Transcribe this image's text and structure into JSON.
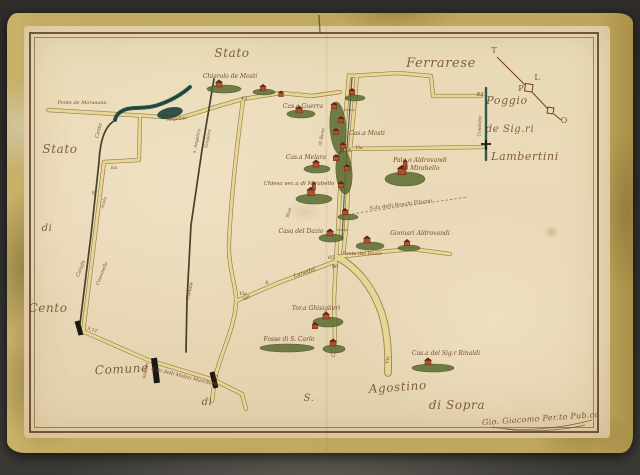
{
  "colors": {
    "photo_bg": "#2e2d2a",
    "margin": "#bfa65e",
    "paper": "#e9dbb6",
    "frame": "#53301c",
    "ink": "#6b4423",
    "ink_red": "#7a3b24",
    "road_fill": "#e7d795",
    "road_edge": "#8a6a38",
    "canal_dark": "#46412c",
    "water_teal": "#2c5a4e",
    "green_dark": "#5c6b31",
    "house_wall": "#b0512c",
    "house_roof": "#5f2714",
    "black": "#1c1812"
  },
  "map": {
    "labels": [
      {
        "name": "stato-top",
        "text": "Stato",
        "x": 232,
        "y": 57,
        "s": 12,
        "r": 0,
        "c": "big"
      },
      {
        "name": "ferrarese",
        "text": "Ferrarese",
        "x": 441,
        "y": 67,
        "s": 13,
        "r": 0,
        "c": "big"
      },
      {
        "name": "stato-left",
        "text": "Stato",
        "x": 60,
        "y": 153,
        "s": 12,
        "r": 0,
        "c": "big"
      },
      {
        "name": "di-left",
        "text": "di",
        "x": 47,
        "y": 231,
        "s": 10,
        "r": 0,
        "c": "big"
      },
      {
        "name": "cento",
        "text": "Cento",
        "x": 48,
        "y": 312,
        "s": 12,
        "r": 0,
        "c": "big"
      },
      {
        "name": "comune",
        "text": "Comune",
        "x": 122,
        "y": 373,
        "s": 12,
        "r": -3,
        "c": "big"
      },
      {
        "name": "di-bottom",
        "text": "di",
        "x": 207,
        "y": 405,
        "s": 10,
        "r": 0,
        "c": "big"
      },
      {
        "name": "s-bottom",
        "text": "S.",
        "x": 309,
        "y": 401,
        "s": 10,
        "r": 0,
        "c": "big"
      },
      {
        "name": "agostino",
        "text": "Agostino",
        "x": 398,
        "y": 391,
        "s": 12,
        "r": -4,
        "c": "big"
      },
      {
        "name": "di-sopra",
        "text": "di Sopra",
        "x": 457,
        "y": 409,
        "s": 12,
        "r": 0,
        "c": "big"
      },
      {
        "name": "poggio",
        "text": "Poggio",
        "x": 507,
        "y": 104,
        "s": 11,
        "r": 0,
        "c": "big"
      },
      {
        "name": "de-sigri",
        "text": "de Sig.ri",
        "x": 510,
        "y": 132,
        "s": 10,
        "r": 0,
        "c": "big"
      },
      {
        "name": "lambertini",
        "text": "Lambertini",
        "x": 525,
        "y": 160,
        "s": 11,
        "r": 0,
        "c": "big"
      },
      {
        "name": "chiarolo-de-mosti",
        "text": "Chiarolo de Mosti",
        "x": 230,
        "y": 78,
        "s": 6,
        "r": 0,
        "c": "small"
      },
      {
        "name": "ponte-de-morasana",
        "text": "Ponte de Morasana",
        "x": 82,
        "y": 104,
        "s": 5,
        "r": 0,
        "c": "small"
      },
      {
        "name": "casa-guerra",
        "text": "Cas.a Guerra",
        "x": 303,
        "y": 108,
        "s": 6,
        "r": 0,
        "c": "small"
      },
      {
        "name": "casa-mosti",
        "text": "Cas.a Mosti",
        "x": 367,
        "y": 135,
        "s": 6,
        "r": 0,
        "c": "small"
      },
      {
        "name": "casa-melara",
        "text": "Cas.a Melara",
        "x": 306,
        "y": 159,
        "s": 6,
        "r": 0,
        "c": "small"
      },
      {
        "name": "chiesa-vecchia-mirabello",
        "text": "Chiesa vec.a di Mirabello",
        "x": 299,
        "y": 185,
        "s": 5.5,
        "r": 0,
        "c": "small"
      },
      {
        "name": "casa-del-dazio",
        "text": "Casa del Dazio",
        "x": 301,
        "y": 233,
        "s": 6,
        "r": 0,
        "c": "small"
      },
      {
        "name": "palazzo-aldrovandi-line1",
        "text": "Palg.o Aldrovandi",
        "x": 420,
        "y": 162,
        "s": 6,
        "r": 0,
        "c": "small"
      },
      {
        "name": "palazzo-aldrovandi-line2",
        "text": "di Mirabello",
        "x": 421,
        "y": 170,
        "s": 6,
        "r": 0,
        "c": "small"
      },
      {
        "name": "gonnari-aldrovandi",
        "text": "Gonnari Aldrovandi",
        "x": 420,
        "y": 235,
        "s": 6,
        "r": 0,
        "c": "small"
      },
      {
        "name": "ponte-del-dazio",
        "text": "Ponte del Dazio",
        "x": 362,
        "y": 255,
        "s": 5,
        "r": 0,
        "c": "small"
      },
      {
        "name": "torre-ghisiglieri",
        "text": "Tor.a Ghisiglieri",
        "x": 316,
        "y": 310,
        "s": 6,
        "r": 0,
        "c": "small"
      },
      {
        "name": "fosse-di-s-carlo",
        "text": "Fosse di S. Carlo",
        "x": 289,
        "y": 341,
        "s": 6,
        "r": 0,
        "c": "small"
      },
      {
        "name": "casa-rinaldi",
        "text": "Cas.a del Sig.r Rinaldi",
        "x": 446,
        "y": 355,
        "s": 6,
        "r": 0,
        "c": "small"
      },
      {
        "name": "strada-molini-marchetti",
        "text": "S.da delli Molini Marchetti",
        "x": 184,
        "y": 378,
        "s": 5,
        "r": 14,
        "c": "small"
      },
      {
        "name": "strada-ronchi-filzano",
        "text": "S.da delli Ronchi Filzano",
        "x": 401,
        "y": 206,
        "s": 5,
        "r": -7,
        "c": "small"
      },
      {
        "name": "lunedel",
        "text": "Lunedel",
        "x": 305,
        "y": 274,
        "s": 5.5,
        "r": -18,
        "c": "small"
      },
      {
        "name": "signature",
        "text": "Gio. Giacomo Per.to Pub.co",
        "x": 541,
        "y": 421,
        "s": 8,
        "r": -4,
        "c": "sig"
      },
      {
        "name": "num-43",
        "text": "43",
        "x": 244,
        "y": 100,
        "s": 5,
        "r": 0,
        "c": "tiny"
      },
      {
        "name": "num-83",
        "text": "83.",
        "x": 481,
        "y": 96,
        "s": 5.5,
        "r": 0,
        "c": "tiny"
      },
      {
        "name": "num-44",
        "text": "44",
        "x": 348,
        "y": 151,
        "s": 5,
        "r": 0,
        "c": "tiny"
      },
      {
        "name": "via-near-44",
        "text": "Via",
        "x": 359,
        "y": 149,
        "s": 4.5,
        "r": 0,
        "c": "tiny"
      },
      {
        "name": "num-85",
        "text": "85",
        "x": 331,
        "y": 259,
        "s": 5,
        "r": 0,
        "c": "tiny"
      },
      {
        "name": "num-80",
        "text": "80",
        "x": 335,
        "y": 268,
        "s": 5,
        "r": 0,
        "c": "tiny"
      },
      {
        "name": "num-h12",
        "text": "h.12",
        "x": 92,
        "y": 331,
        "s": 4.5,
        "r": 18,
        "c": "tiny"
      },
      {
        "name": "num-813",
        "text": "8.13",
        "x": 217,
        "y": 380,
        "s": 4.5,
        "r": -75,
        "c": "tiny"
      },
      {
        "name": "letter-b",
        "text": "b",
        "x": 267,
        "y": 284,
        "s": 5,
        "r": 0,
        "c": "tiny"
      },
      {
        "name": "val",
        "text": "Val",
        "x": 247,
        "y": 299,
        "s": 4.5,
        "r": -30,
        "c": "tiny"
      },
      {
        "name": "via-west",
        "text": "via",
        "x": 114,
        "y": 169,
        "s": 4.5,
        "r": 0,
        "c": "tiny"
      },
      {
        "name": "via-center",
        "text": "Via",
        "x": 243,
        "y": 295,
        "s": 4.5,
        "r": 0,
        "c": "tiny"
      },
      {
        "name": "via-south",
        "text": "Via",
        "x": 389,
        "y": 360,
        "s": 4.5,
        "r": -85,
        "c": "tiny"
      },
      {
        "name": "angelino",
        "text": "Angelino",
        "x": 177,
        "y": 120,
        "s": 4.5,
        "r": -6,
        "c": "tiny red"
      },
      {
        "name": "canal-cento",
        "text": "Cento",
        "x": 100,
        "y": 131,
        "s": 5,
        "r": -75,
        "c": "tiny"
      },
      {
        "name": "canal-di",
        "text": "di",
        "x": 95,
        "y": 193,
        "s": 4.5,
        "r": -75,
        "c": "tiny"
      },
      {
        "name": "canal-scolo",
        "text": "scolo",
        "x": 105,
        "y": 203,
        "s": 4.5,
        "r": -72,
        "c": "tiny"
      },
      {
        "name": "canale-sw",
        "text": "Canale",
        "x": 82,
        "y": 269,
        "s": 5,
        "r": -68,
        "c": "tiny"
      },
      {
        "name": "cassanello",
        "text": "Cassanello",
        "x": 103,
        "y": 274,
        "s": 4.5,
        "r": -68,
        "c": "tiny"
      },
      {
        "name": "s-angelica",
        "text": "s. Angelica",
        "x": 198,
        "y": 141,
        "s": 4.5,
        "r": -78,
        "c": "tiny"
      },
      {
        "name": "gasparo",
        "text": "Gasparo",
        "x": 209,
        "y": 139,
        "s": 4.5,
        "r": -78,
        "c": "tiny"
      },
      {
        "name": "canale-mid",
        "text": "Canale",
        "x": 191,
        "y": 291,
        "s": 5,
        "r": -78,
        "c": "tiny"
      },
      {
        "name": "condotto",
        "text": "Condotto",
        "x": 481,
        "y": 126,
        "s": 4.5,
        "r": -87,
        "c": "tiny"
      },
      {
        "name": "di-reno",
        "text": "di Reno",
        "x": 323,
        "y": 137,
        "s": 4.5,
        "r": -80,
        "c": "tiny"
      },
      {
        "name": "riva",
        "text": "Riva",
        "x": 290,
        "y": 213,
        "s": 4.5,
        "r": -75,
        "c": "tiny"
      },
      {
        "name": "molino",
        "text": "Molino",
        "x": 147,
        "y": 371,
        "s": 4.5,
        "r": -80,
        "c": "tiny red"
      }
    ],
    "compass": {
      "letters": [
        {
          "t": "T",
          "x": 494,
          "y": 53
        },
        {
          "t": "L",
          "x": 537,
          "y": 80
        },
        {
          "t": "P",
          "x": 521,
          "y": 91
        },
        {
          "t": "O",
          "x": 564,
          "y": 123
        }
      ]
    },
    "houses": [
      {
        "x": 219,
        "y": 85,
        "sc": 1,
        "tw": 0
      },
      {
        "x": 263,
        "y": 89,
        "sc": 0.9,
        "tw": 0
      },
      {
        "x": 281,
        "y": 95,
        "sc": 0.8,
        "tw": 0
      },
      {
        "x": 299,
        "y": 111,
        "sc": 1,
        "tw": 0
      },
      {
        "x": 352,
        "y": 93,
        "sc": 0.9,
        "tw": 0
      },
      {
        "x": 334,
        "y": 107,
        "sc": 0.9,
        "tw": 0
      },
      {
        "x": 341,
        "y": 121,
        "sc": 0.9,
        "tw": 0
      },
      {
        "x": 336,
        "y": 133,
        "sc": 0.9,
        "tw": 0
      },
      {
        "x": 343,
        "y": 147,
        "sc": 0.9,
        "tw": 0
      },
      {
        "x": 336,
        "y": 159,
        "sc": 0.9,
        "tw": 0
      },
      {
        "x": 347,
        "y": 169,
        "sc": 0.9,
        "tw": 0
      },
      {
        "x": 341,
        "y": 186,
        "sc": 0.9,
        "tw": 0
      },
      {
        "x": 345,
        "y": 213,
        "sc": 0.9,
        "tw": 0
      },
      {
        "x": 316,
        "y": 165,
        "sc": 1,
        "tw": 0
      },
      {
        "x": 311,
        "y": 193,
        "sc": 1.15,
        "tw": 1
      },
      {
        "x": 330,
        "y": 234,
        "sc": 1,
        "tw": 0
      },
      {
        "x": 402,
        "y": 172,
        "sc": 1.3,
        "tw": 1
      },
      {
        "x": 367,
        "y": 241,
        "sc": 1,
        "tw": 0
      },
      {
        "x": 407,
        "y": 244,
        "sc": 0.9,
        "tw": 0
      },
      {
        "x": 326,
        "y": 317,
        "sc": 1,
        "tw": 0
      },
      {
        "x": 315,
        "y": 327,
        "sc": 0.9,
        "tw": 0
      },
      {
        "x": 333,
        "y": 344,
        "sc": 1,
        "tw": 0
      },
      {
        "x": 428,
        "y": 363,
        "sc": 1,
        "tw": 0
      }
    ],
    "greens": [
      {
        "x": 224,
        "y": 89,
        "rx": 17,
        "ry": 4,
        "r": 0
      },
      {
        "x": 264,
        "y": 92,
        "rx": 11,
        "ry": 3,
        "r": 0
      },
      {
        "x": 301,
        "y": 114,
        "rx": 14,
        "ry": 4,
        "r": 0
      },
      {
        "x": 355,
        "y": 98,
        "rx": 10,
        "ry": 3,
        "r": 0
      },
      {
        "x": 338,
        "y": 128,
        "rx": 8,
        "ry": 26,
        "r": -4
      },
      {
        "x": 344,
        "y": 172,
        "rx": 8,
        "ry": 22,
        "r": -4
      },
      {
        "x": 317,
        "y": 169,
        "rx": 13,
        "ry": 4,
        "r": 0
      },
      {
        "x": 314,
        "y": 199,
        "rx": 18,
        "ry": 5,
        "r": 0
      },
      {
        "x": 331,
        "y": 238,
        "rx": 12,
        "ry": 4,
        "r": 0
      },
      {
        "x": 348,
        "y": 217,
        "rx": 10,
        "ry": 3,
        "r": 0
      },
      {
        "x": 405,
        "y": 179,
        "rx": 20,
        "ry": 7,
        "r": 0
      },
      {
        "x": 370,
        "y": 246,
        "rx": 14,
        "ry": 4,
        "r": 0
      },
      {
        "x": 409,
        "y": 248,
        "rx": 11,
        "ry": 3,
        "r": 0
      },
      {
        "x": 328,
        "y": 322,
        "rx": 15,
        "ry": 5,
        "r": 0
      },
      {
        "x": 287,
        "y": 348,
        "rx": 27,
        "ry": 4,
        "r": 0
      },
      {
        "x": 334,
        "y": 349,
        "rx": 11,
        "ry": 4,
        "r": 0
      },
      {
        "x": 433,
        "y": 368,
        "rx": 21,
        "ry": 4,
        "r": 0
      }
    ]
  }
}
